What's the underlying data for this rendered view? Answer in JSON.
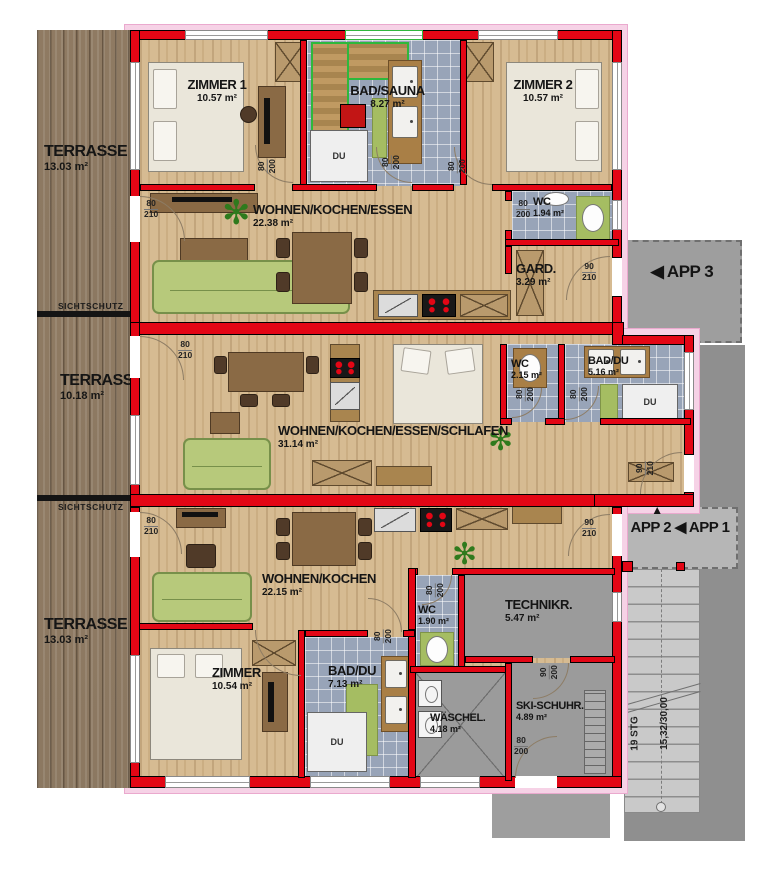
{
  "plan": {
    "labels": {
      "sichtschutz": "SICHTSCHUTZ",
      "du": "DU"
    },
    "terraces": [
      {
        "name": "TERRASSE",
        "area": "13.03 m²"
      },
      {
        "name": "TERRASSE",
        "area": "10.18 m²"
      },
      {
        "name": "TERRASSE",
        "area": "13.03 m²"
      }
    ],
    "apartments": {
      "app3": {
        "sign": "◀ APP 3",
        "rooms": {
          "zimmer1": {
            "name": "ZIMMER 1",
            "area": "10.57 m²"
          },
          "bad_sauna": {
            "name": "BAD/SAUNA",
            "area": "8.27 m²"
          },
          "zimmer2": {
            "name": "ZIMMER 2",
            "area": "10.57 m²"
          },
          "wohnen": {
            "name": "WOHNEN/KOCHEN/ESSEN",
            "area": "22.38 m²"
          },
          "wc": {
            "name": "WC",
            "area": "1.94 m²"
          },
          "gard": {
            "name": "GARD.",
            "area": "3.29 m²"
          }
        }
      },
      "app2": {
        "up_arrow": "▲",
        "sign": "APP 2",
        "sign_app1": "◀ APP 1",
        "rooms": {
          "wohnen": {
            "name": "WOHNEN/KOCHEN/ESSEN/SCHLAFEN",
            "area": "31.14 m²"
          },
          "wc": {
            "name": "WC",
            "area": "2.15 m²"
          },
          "bad_du": {
            "name": "BAD/DU",
            "area": "5.16 m²"
          }
        }
      },
      "app1": {
        "rooms": {
          "wohnen": {
            "name": "WOHNEN/KOCHEN",
            "area": "22.15 m²"
          },
          "zimmer": {
            "name": "ZIMMER",
            "area": "10.54 m²"
          },
          "bad_du": {
            "name": "BAD/DU",
            "area": "7.13 m²"
          },
          "wc": {
            "name": "WC",
            "area": "1.90 m²"
          },
          "technik": {
            "name": "TECHNIKR.",
            "area": "5.47 m²"
          },
          "waesche": {
            "name": "WÄSCHEL.",
            "area": "4.18 m²"
          },
          "ski": {
            "name": "SKI-SCHUHR.",
            "area": "4.89 m²"
          }
        }
      }
    },
    "stairs": {
      "steps": "19 STG",
      "dimension": "15,32/30,00"
    },
    "doors": {
      "terrace": {
        "w": "80",
        "h": "210"
      },
      "interior": {
        "w": "80",
        "h": "200"
      },
      "entrance": {
        "w": "90",
        "h": "210"
      },
      "tech": {
        "w": "90",
        "h": "200"
      }
    },
    "colors": {
      "wall_red": "#e30615",
      "insulation_pink": "#f6d2e6",
      "tile_blue": "#98a4b8",
      "concrete_gray": "#9b9b9b",
      "wood_tan": "#d6bb92",
      "terrace_wood": "#a08b72",
      "accent_green": "#a5bd62",
      "sauna_green": "#2eb83c"
    }
  }
}
